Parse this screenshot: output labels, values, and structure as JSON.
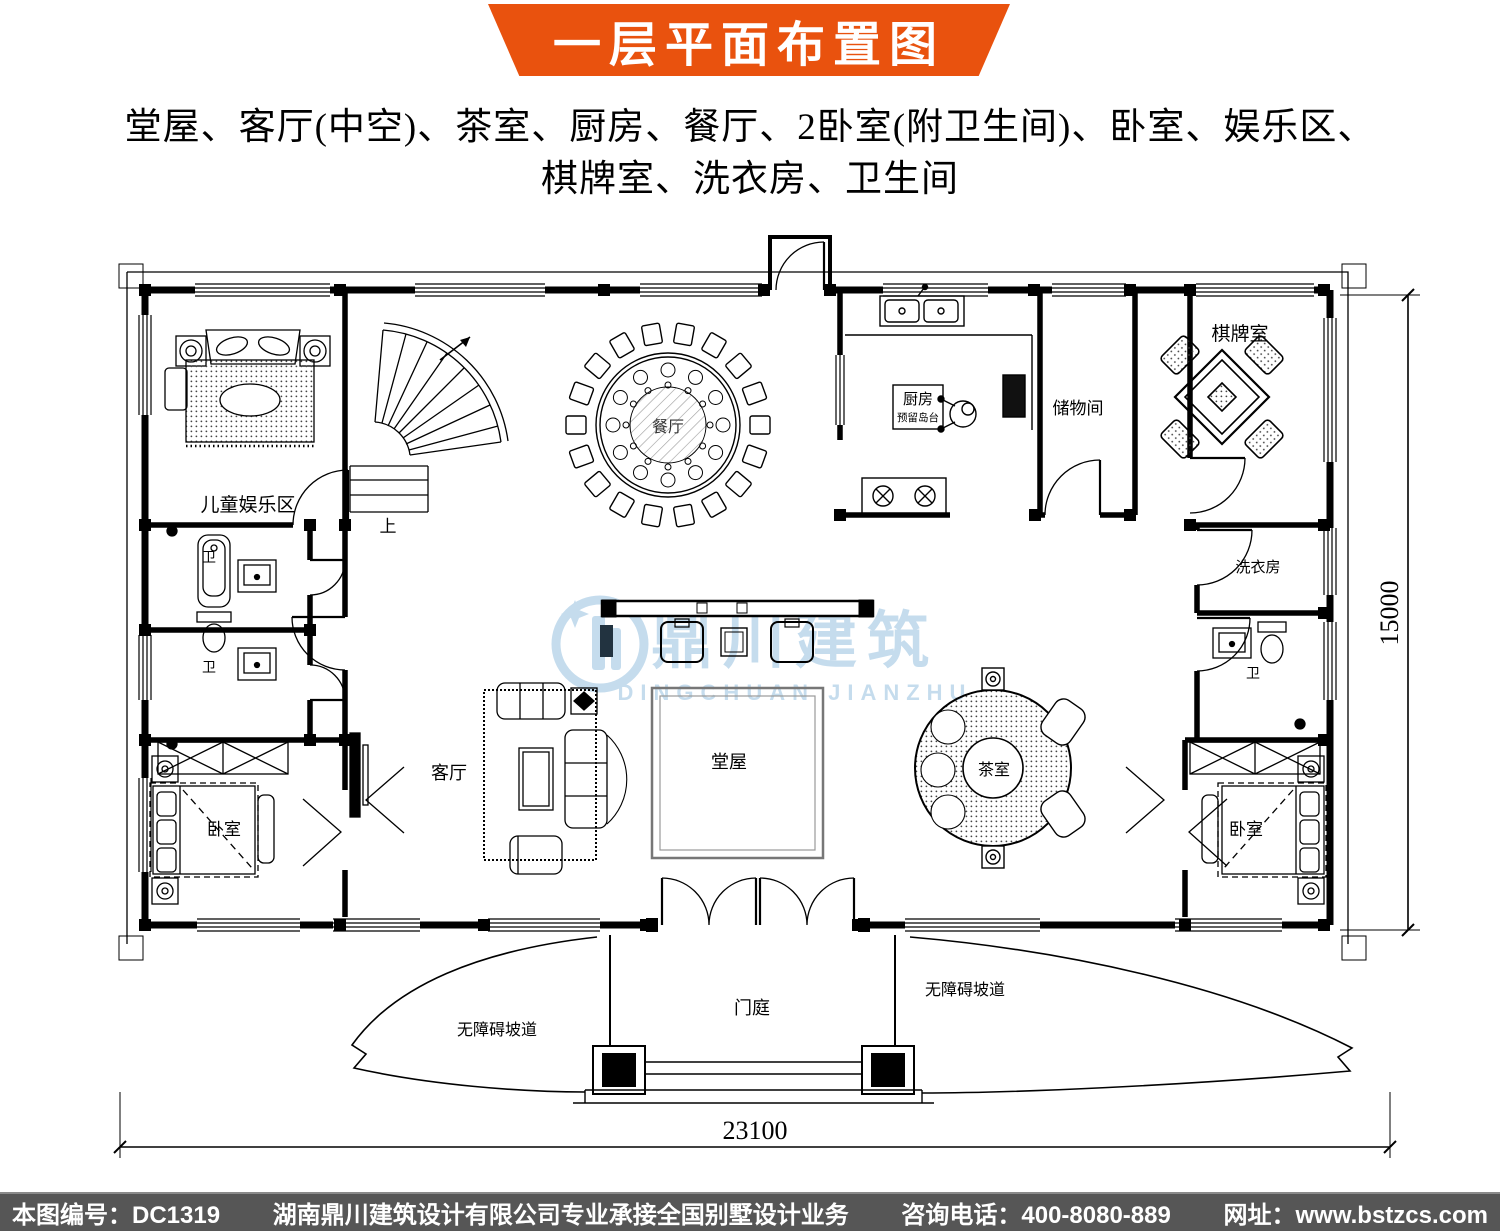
{
  "header": {
    "title": "一层平面布置图",
    "banner_color": "#e9520e"
  },
  "subtitle": {
    "line1": "堂屋、客厅(中空)、茶室、厨房、餐厅、2卧室(附卫生间)、卧室、娱乐区、",
    "line2": "棋牌室、洗衣房、卫生间"
  },
  "plan": {
    "labels": {
      "children_area": "儿童娱乐区",
      "stairs_up": "上",
      "dining": "餐厅",
      "kitchen": "厨房",
      "kitchen_island": "预留岛台",
      "storage": "储物间",
      "chess_room": "棋牌室",
      "laundry": "洗衣房",
      "bath": "卫",
      "bedroom": "卧室",
      "living": "客厅",
      "hall": "堂屋",
      "tea_room": "茶室",
      "porch": "门庭",
      "ramp": "无障碍坡道"
    },
    "dimensions": {
      "width": "23100",
      "height": "15000"
    }
  },
  "watermark": {
    "name_cn": "鼎川建筑",
    "name_en": "DINGCHUAN JIANZHU",
    "color": "#7fb3d9"
  },
  "footer": {
    "drawing_no": "本图编号：DC1319",
    "company": "湖南鼎川建筑设计有限公司专业承接全国别墅设计业务",
    "phone": "咨询电话：400-8080-889",
    "website": "网址：www.bstzcs.com"
  }
}
